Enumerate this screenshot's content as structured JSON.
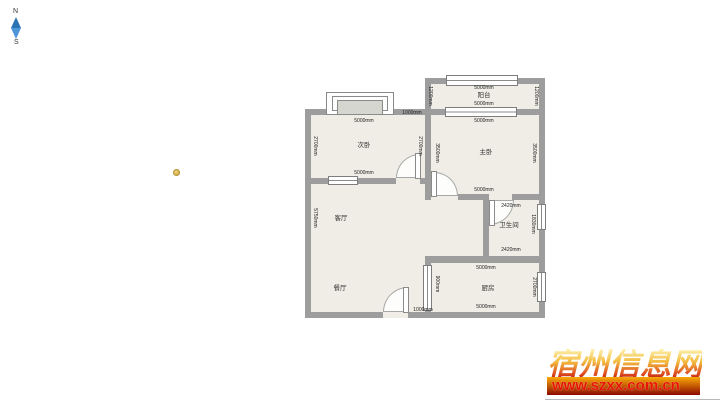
{
  "compass": {
    "north": "N",
    "south": "S"
  },
  "floorplan": {
    "balcony": {
      "label": "阳台",
      "dim_top": "5000mm",
      "dim_bottom": "5000mm",
      "dim_left": "1200mm",
      "dim_right": "1200mm"
    },
    "master_bedroom": {
      "label": "主卧",
      "dim_top": "5000mm",
      "dim_bottom": "5000mm",
      "dim_left": "3500mm",
      "dim_right": "3500mm"
    },
    "second_bedroom": {
      "label": "次卧",
      "dim_top": "5000mm",
      "dim_bottom": "5000mm",
      "dim_left": "2700mm",
      "dim_right": "2700mm",
      "dim_wall_segment": "1000mm"
    },
    "living_room": {
      "label": "客厅",
      "dim_left": "5750mm"
    },
    "dining_room": {
      "label": "餐厅",
      "dim_bottom": "1000mm",
      "dim_kitchen_door": "900mm"
    },
    "bathroom": {
      "label": "卫生间",
      "dim_top": "2420mm",
      "dim_bottom": "2420mm",
      "dim_right": "1830mm"
    },
    "kitchen": {
      "label": "厨房",
      "dim_top": "5000mm",
      "dim_bottom": "5000mm",
      "dim_right": "2700mm"
    }
  },
  "watermark": {
    "site_name": "宿州信息网",
    "url": "www.szxx.com.cn"
  },
  "colors": {
    "wall": "#9d9d9d",
    "floor": "#efede5",
    "marker": "#c9a53a",
    "watermark_bar_top": "#f9a906",
    "watermark_bar_bottom": "#8c0a02",
    "watermark_text": "#e81402"
  }
}
